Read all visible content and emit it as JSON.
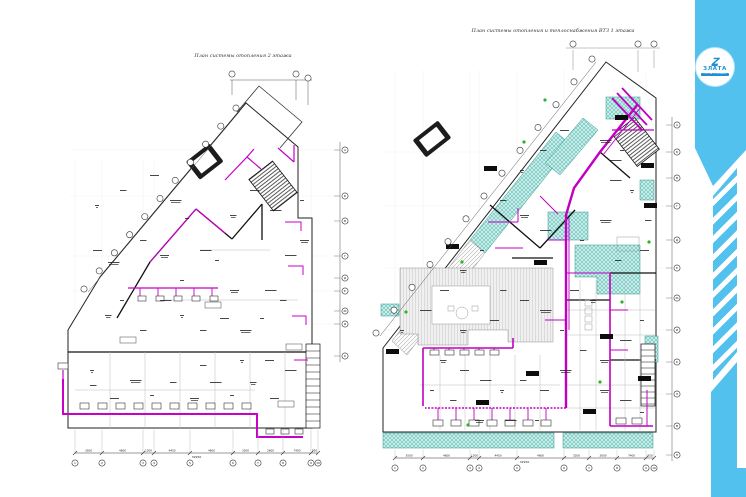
{
  "sheet": {
    "background": "#ffffff"
  },
  "brand": {
    "band_color": "#52c1ee",
    "logo_symbol": "Z",
    "logo_name": "ЗЛАТА",
    "logo_subtitle": "ГРУППА КОМПАНИЙ"
  },
  "plans": {
    "left": {
      "title": "План системы отопления 2 этажа",
      "bottom_axis_labels": [
        "1",
        "2",
        "3",
        "4",
        "5",
        "6",
        "7",
        "8",
        "9",
        "10"
      ],
      "side_axis_labels": [
        "А",
        "Б",
        "В",
        "Г",
        "Д",
        "Е",
        "Ж",
        "И",
        "К"
      ],
      "dim_segments": [
        "3500",
        "4600",
        "1200",
        "4450",
        "4600",
        "3200",
        "2600",
        "7400",
        "950"
      ],
      "dim_total": "32950"
    },
    "right": {
      "title": "План системы отопления и теплоснабжения ВТЗ 1 этажа",
      "bottom_axis_labels": [
        "1",
        "2",
        "3",
        "4",
        "5",
        "6",
        "7",
        "8",
        "9",
        "10"
      ],
      "side_axis_labels": [
        "А",
        "Б",
        "В",
        "Г",
        "Д",
        "Е",
        "Ж",
        "И",
        "К",
        "Л",
        "М",
        "Н"
      ],
      "dim_segments": [
        "3500",
        "4600",
        "1200",
        "4450",
        "4600",
        "3200",
        "2600",
        "7400",
        "950"
      ],
      "dim_total": "32950"
    }
  },
  "legend_colors": {
    "piping": "#c800c8",
    "heated_zone_fill": "#c9ece8",
    "heated_zone_hatch": "#49b6ab",
    "walls": "#1a1a1a",
    "marker_green": "#2db32d"
  }
}
